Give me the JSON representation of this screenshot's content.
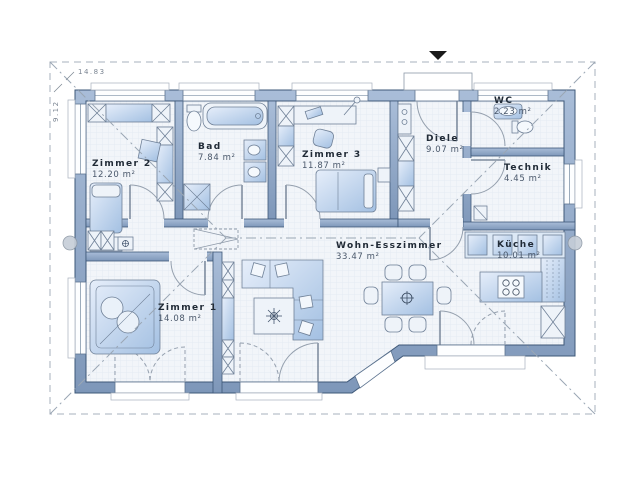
{
  "plan": {
    "rooms": [
      {
        "name": "Zimmer 2",
        "area": "12.20 m²",
        "furniture": [
          "wardrobe",
          "bed",
          "chest",
          "stool",
          "cabinet"
        ]
      },
      {
        "name": "Bad",
        "area": "7.84 m²",
        "furniture": [
          "toilet",
          "bathtub",
          "shower",
          "double-washbasin"
        ]
      },
      {
        "name": "Zimmer 3",
        "area": "11.87 m²",
        "furniture": [
          "wardrobe",
          "desk",
          "office-chair",
          "bed",
          "nightstand"
        ]
      },
      {
        "name": "Diele",
        "area": "9.07 m²",
        "furniture": [
          "shoe-cabinet",
          "wardrobe"
        ]
      },
      {
        "name": "WC",
        "area": "2.23 m²",
        "furniture": [
          "washbasin",
          "toilet"
        ]
      },
      {
        "name": "Technik",
        "area": "4.45 m²",
        "furniture": [
          "utility-box"
        ]
      },
      {
        "name": "Küche",
        "area": "10.01 m²",
        "furniture": [
          "kitchen-counter",
          "fridge-column",
          "cooking-island",
          "tall-cabinet"
        ]
      },
      {
        "name": "Wohn-Esszimmer",
        "area": "33.47 m²",
        "furniture": [
          "dining-table",
          "chairs",
          "corner-sofa",
          "coffee-table",
          "shelf"
        ]
      },
      {
        "name": "Zimmer 1",
        "area": "14.08 m²",
        "furniture": [
          "double-bed",
          "hall-closet",
          "side-table"
        ]
      }
    ],
    "dimensions": {
      "width_label": "14.83",
      "height_label": "9.12"
    },
    "markers": {
      "entrance_icon": "entrance-arrow-down",
      "section_icons": [
        "section-marker-left",
        "section-marker-right"
      ],
      "roof_lines": "hip-roof-dashed-outline",
      "attic_hatch": "attic-access-dashed"
    },
    "colors": {
      "wall": "#8ba3c4",
      "wall_outline": "#3e5878",
      "floor": "#f2f5f9",
      "furniture": "#b8cfe9",
      "dash": "#9aa6b4",
      "text": "#212b37"
    }
  }
}
